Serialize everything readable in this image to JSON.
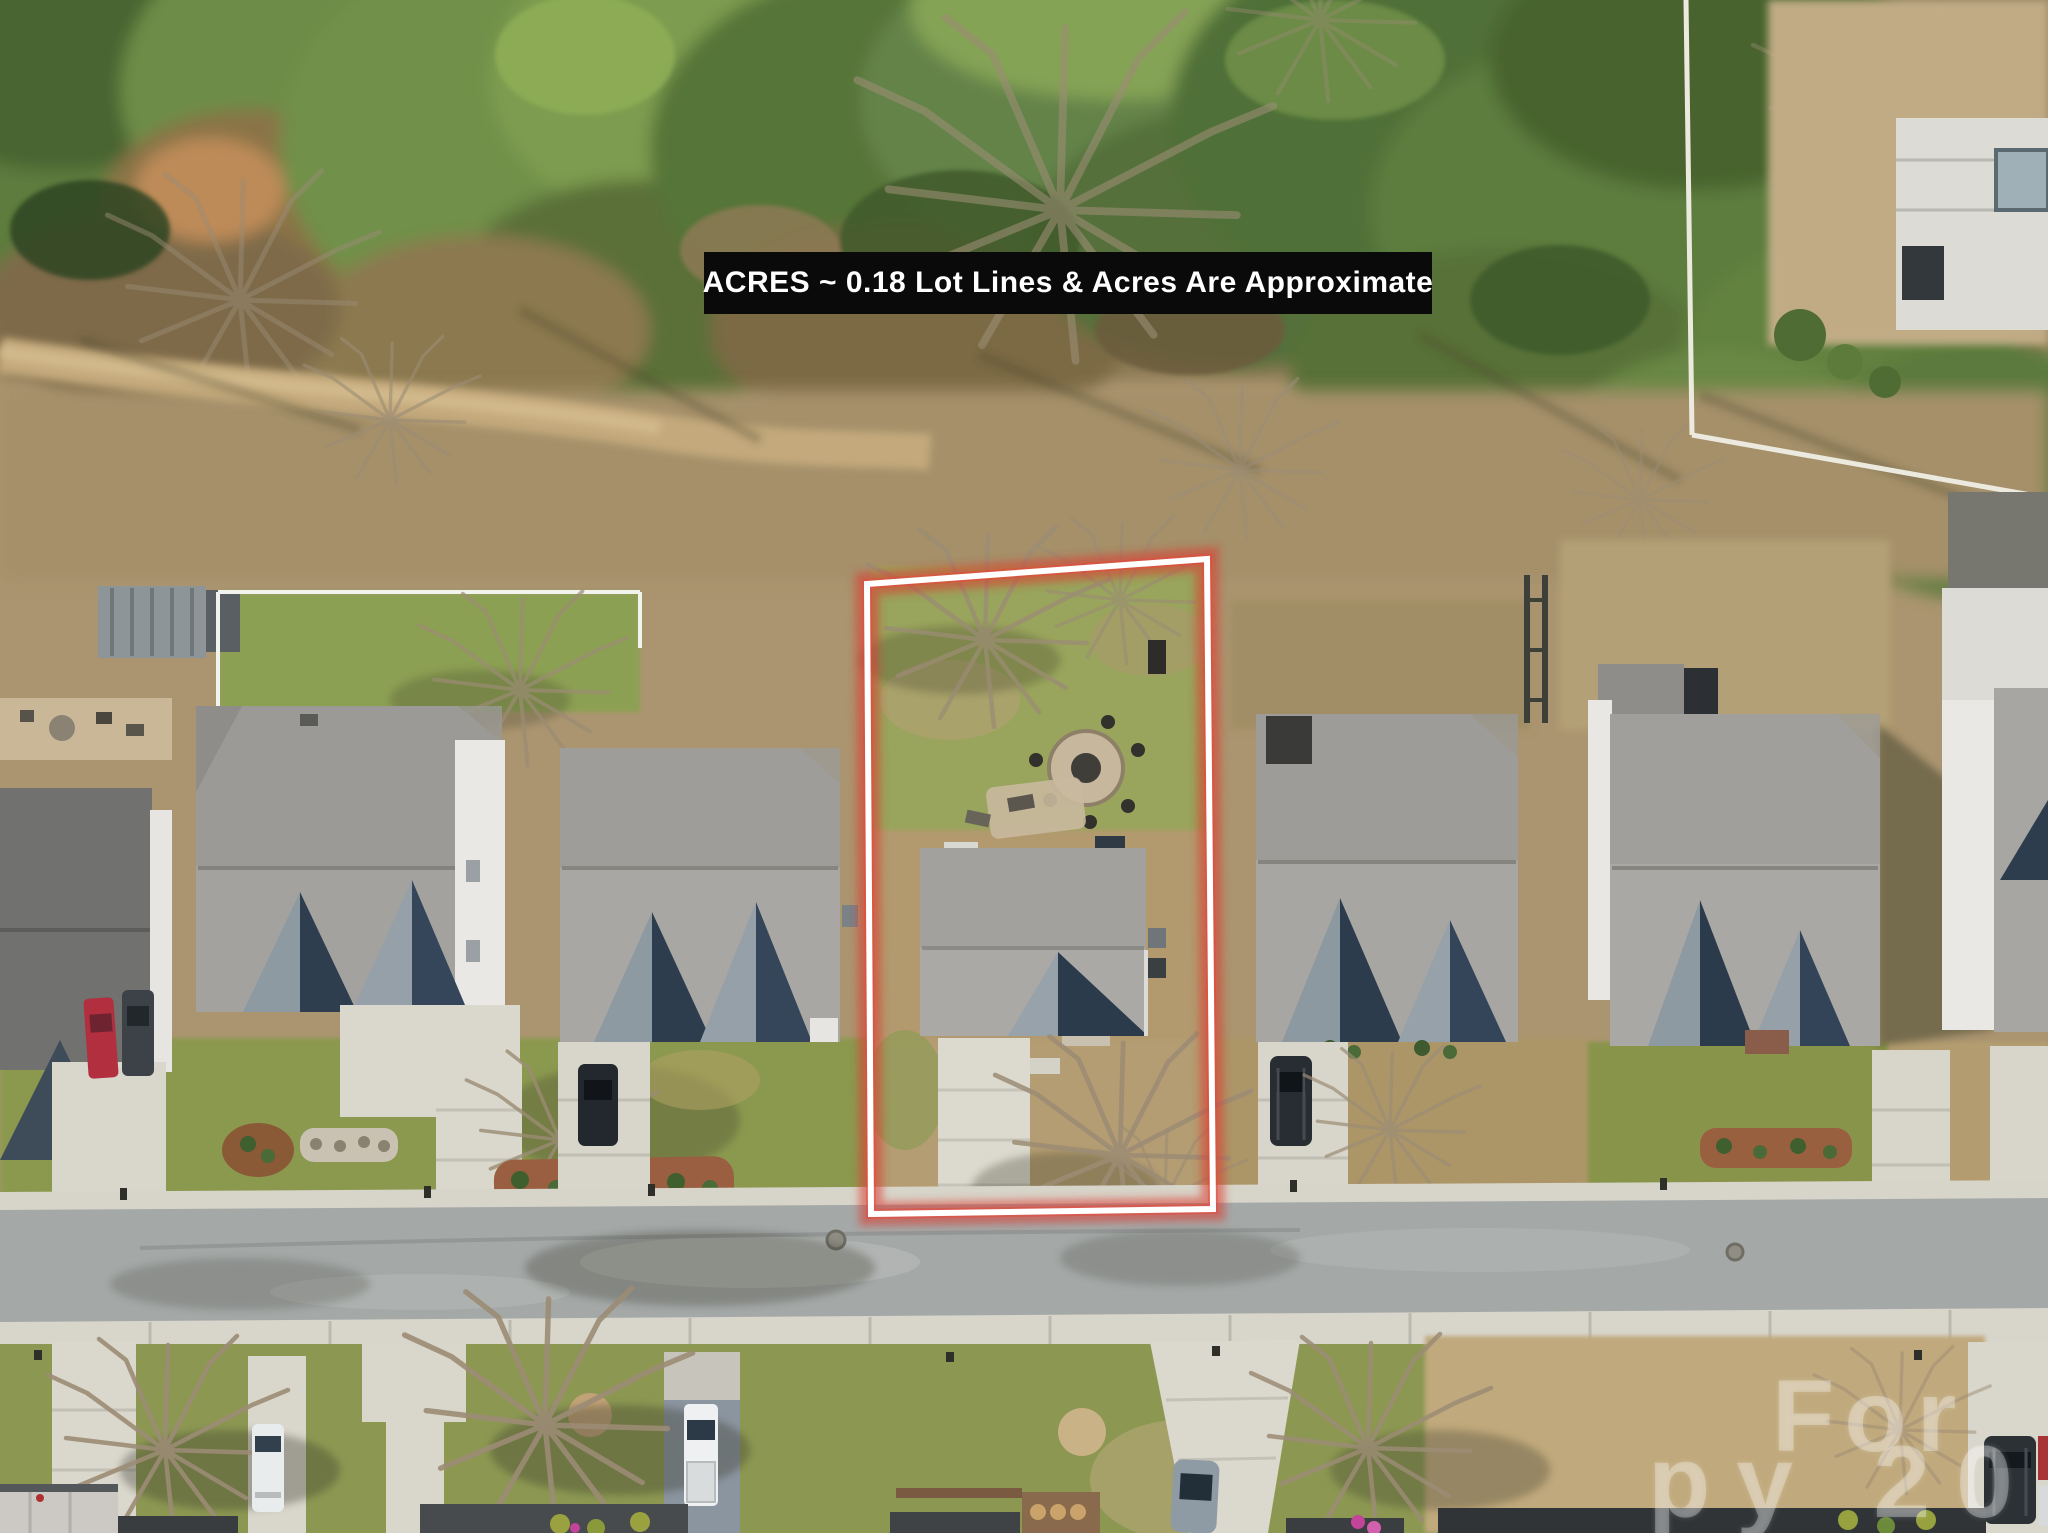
{
  "image": {
    "kind": "aerial-drone-real-estate-photo",
    "width_px": 2048,
    "height_px": 1533
  },
  "overlays": {
    "banner": {
      "text": "ACRES ~ 0.18 Lot Lines & Acres Are Approximate",
      "bg_color": "#0a0a0a",
      "text_color": "#ffffff"
    },
    "watermark": {
      "line1": "For",
      "line2": "py 20",
      "color": "rgba(255,255,255,0.30)"
    },
    "lot_outline": {
      "stroke_color": "#ffffff",
      "glow_color": "#dd3a2e",
      "acres": "0.18"
    }
  },
  "scene": {
    "description": "Suburban street viewed from above: forest strip on top, one row of gray-roofed houses, subject lot outlined in red/white, road and opposite front yards at bottom",
    "subject_lot": {
      "outlined": true,
      "has_fire_pit": true,
      "has_driveway": true
    },
    "houses_in_main_row": 6,
    "vehicles": [
      {
        "name": "red-car",
        "color": "#b12f3e"
      },
      {
        "name": "dark-car-left",
        "color": "#3c4248"
      },
      {
        "name": "dark-car-house2",
        "color": "#22282d"
      },
      {
        "name": "dark-suv-house3",
        "color": "#272d33"
      },
      {
        "name": "white-van",
        "color": "#e9eced"
      },
      {
        "name": "white-pickup",
        "color": "#eef0f1"
      },
      {
        "name": "gray-sedan",
        "color": "#8e9aa4"
      },
      {
        "name": "dark-suv-bottom-right",
        "color": "#2b3135"
      },
      {
        "name": "red-car-edge",
        "color": "#a83436"
      }
    ]
  }
}
